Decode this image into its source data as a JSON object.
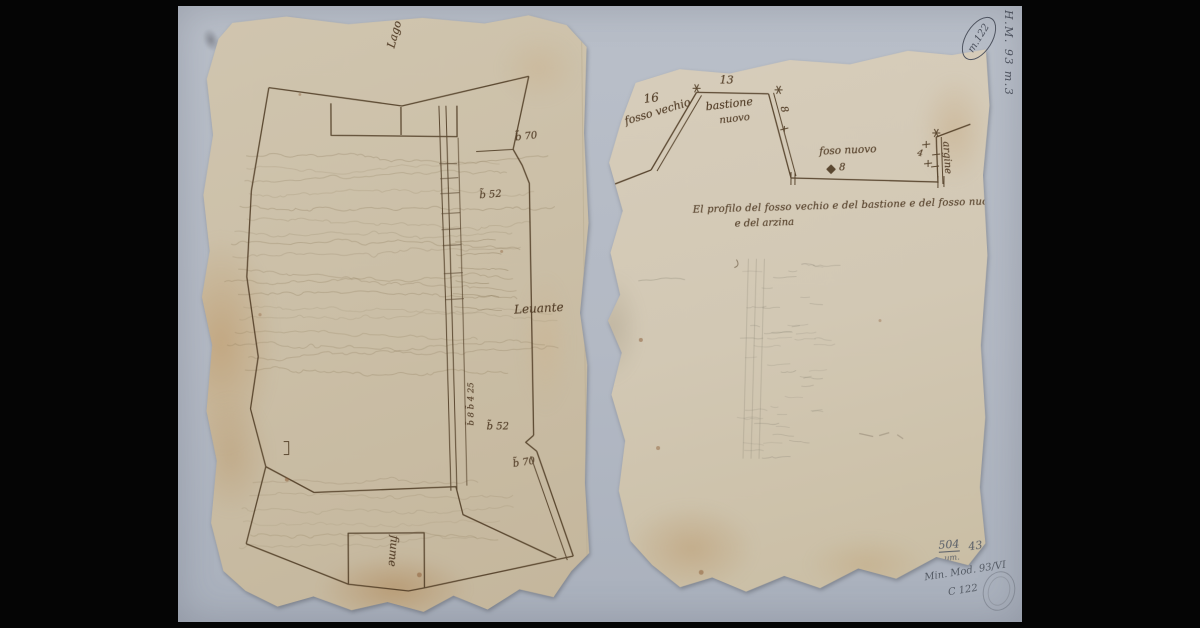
{
  "archive": {
    "shelfmark_vertical": "H.M. 93 m.3",
    "oval_stamp": "m.122",
    "inv_number": "504",
    "inv_sub": "um.",
    "inv_right": "43",
    "catalog_note": "Min. Mod. 93/VI",
    "catalog_code": "C 122"
  },
  "left_sheet": {
    "label_top": "Lago",
    "label_east": "Leuante",
    "label_bottom": "fiume",
    "m_top_right": "b̃ 70",
    "m_upper": "b̃ 52",
    "m_col": "b̃ 8 b̃ 4 25",
    "m_lower": "b̃ 52",
    "m_bottom": "b̃ 70"
  },
  "right_sheet": {
    "n_left": "16",
    "n_top": "13",
    "n_slope": "8",
    "n_ditch": "8",
    "n_bank": "4",
    "lbl_fosso_vecchio": "fosso vechio",
    "lbl_bastione1": "bastione",
    "lbl_bastione2": "nuovo",
    "lbl_fosso_nuovo": "foso nuovo",
    "lbl_argine": "argine",
    "caption1": "El profilo del fosso vechio e del bastione e del fosso nuovo",
    "caption2": "e del arzina"
  }
}
